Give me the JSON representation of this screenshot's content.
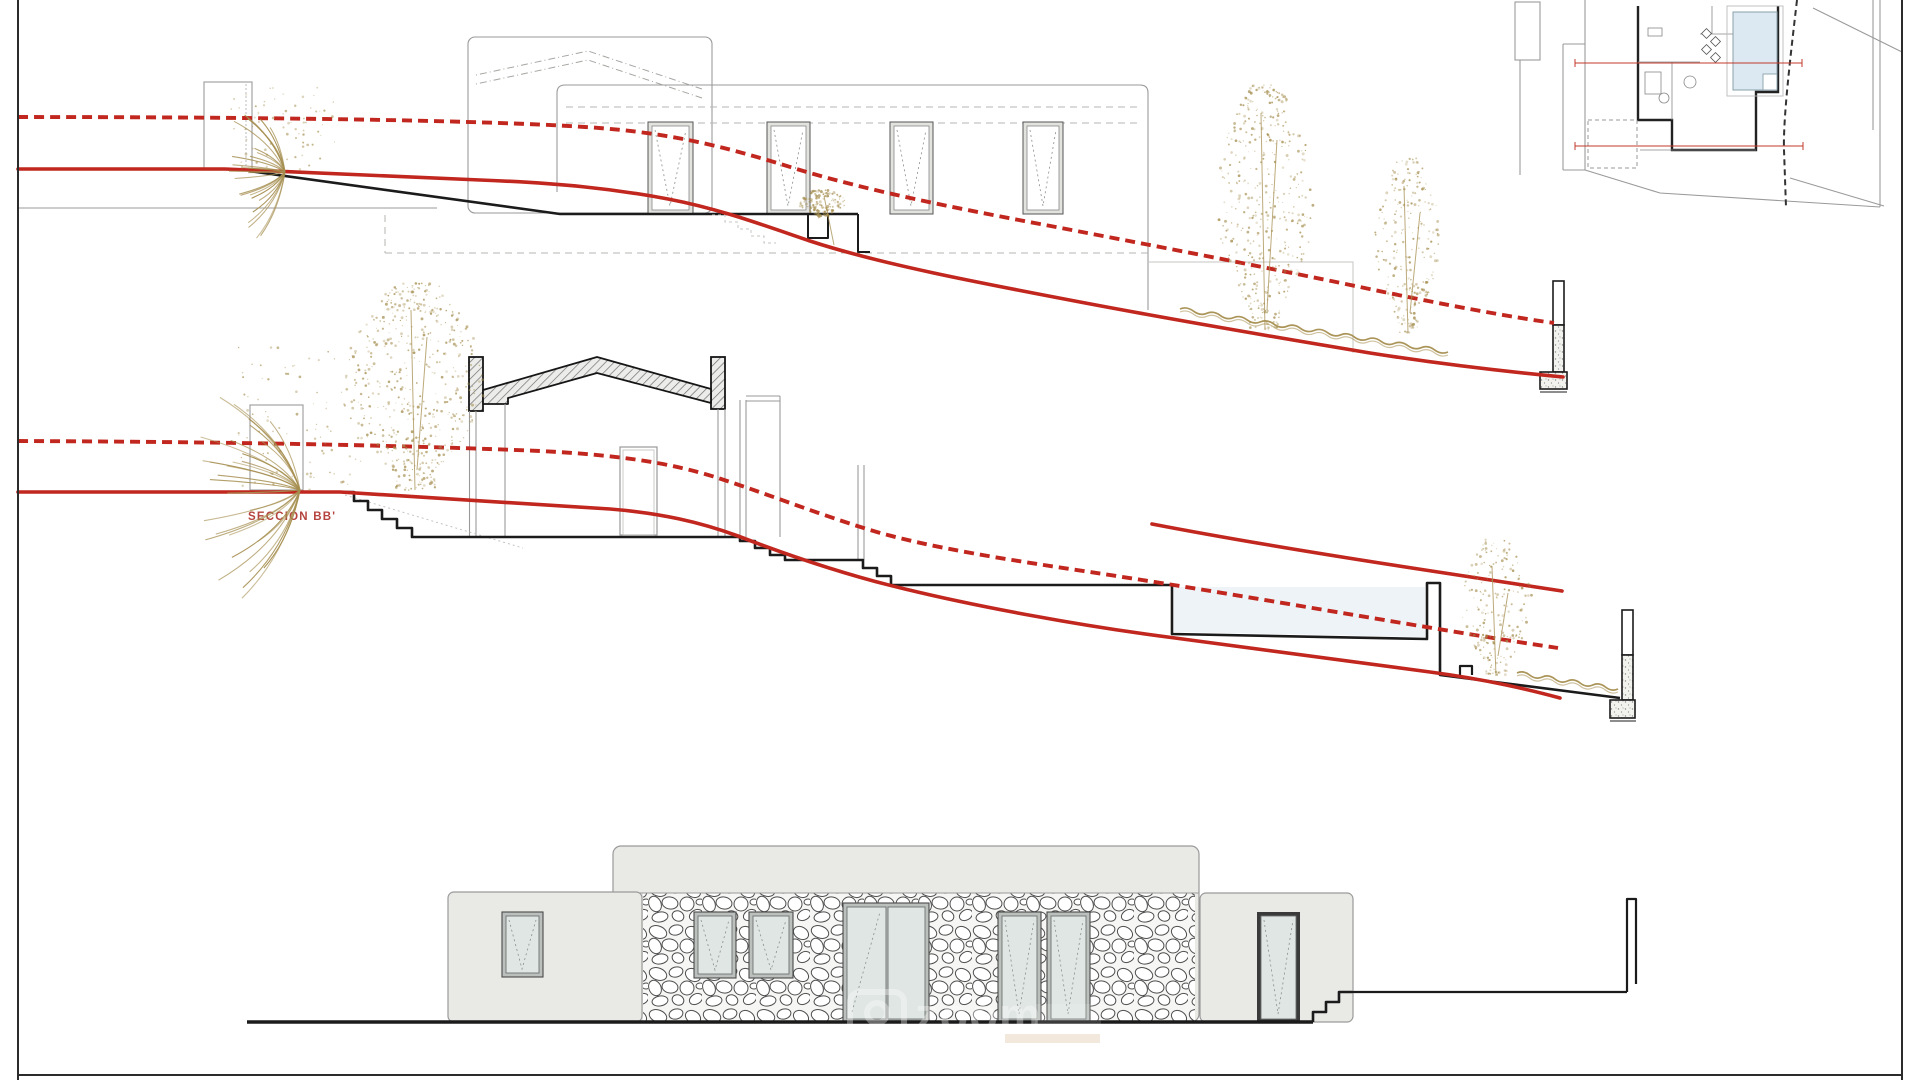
{
  "page": {
    "background": "#ffffff",
    "border_color": "#2b2b2b"
  },
  "labels": {
    "section_bb": "SECCIÓN BB'"
  },
  "watermark": {
    "text": "zoom",
    "color": "#ffffff",
    "opacity": 0.34,
    "subtext_color": "#c69b5f"
  },
  "colors": {
    "red": "#c1271e",
    "vegetation": "#a58e4f",
    "wall_fill": "#e9e9e6",
    "glass": "#dfe6e3",
    "line_gray": "#9a9a9a",
    "black": "#1b1b1b",
    "pool_water": "#edf3f7",
    "label_red": "#b5433e"
  },
  "trees": [
    {
      "id": "tree-top-right-1",
      "cx": 1265,
      "yTop": 85,
      "yBottom": 330,
      "width": 100,
      "dots": 430,
      "seed": 7
    },
    {
      "id": "tree-top-right-2",
      "cx": 1408,
      "yTop": 158,
      "yBottom": 333,
      "width": 66,
      "dots": 240,
      "seed": 11
    },
    {
      "id": "tree-mid-left",
      "cx": 415,
      "yTop": 282,
      "yBottom": 490,
      "width": 140,
      "dots": 540,
      "seed": 3
    },
    {
      "id": "tree-mid-right",
      "cx": 1496,
      "yTop": 538,
      "yBottom": 676,
      "width": 72,
      "dots": 210,
      "seed": 5
    },
    {
      "id": "bush-top-building",
      "cx": 822,
      "yTop": 190,
      "yBottom": 216,
      "width": 48,
      "dots": 160,
      "seed": 13
    }
  ],
  "shrubs": [
    {
      "id": "shrub-top-left",
      "x": 285,
      "y": 172,
      "h": 85,
      "spread": 55,
      "strokes": 26,
      "dots": 70,
      "seed": 2
    },
    {
      "id": "shrub-mid-left",
      "x": 300,
      "y": 490,
      "h": 145,
      "spread": 62,
      "strokes": 30,
      "dots": 90,
      "seed": 4
    }
  ],
  "waves": [
    {
      "x1": 1180,
      "y1": 309,
      "x2": 1448,
      "y2": 352,
      "amp": 4,
      "wl": 13
    },
    {
      "x1": 1517,
      "y1": 673,
      "x2": 1618,
      "y2": 689,
      "amp": 4,
      "wl": 12
    }
  ]
}
